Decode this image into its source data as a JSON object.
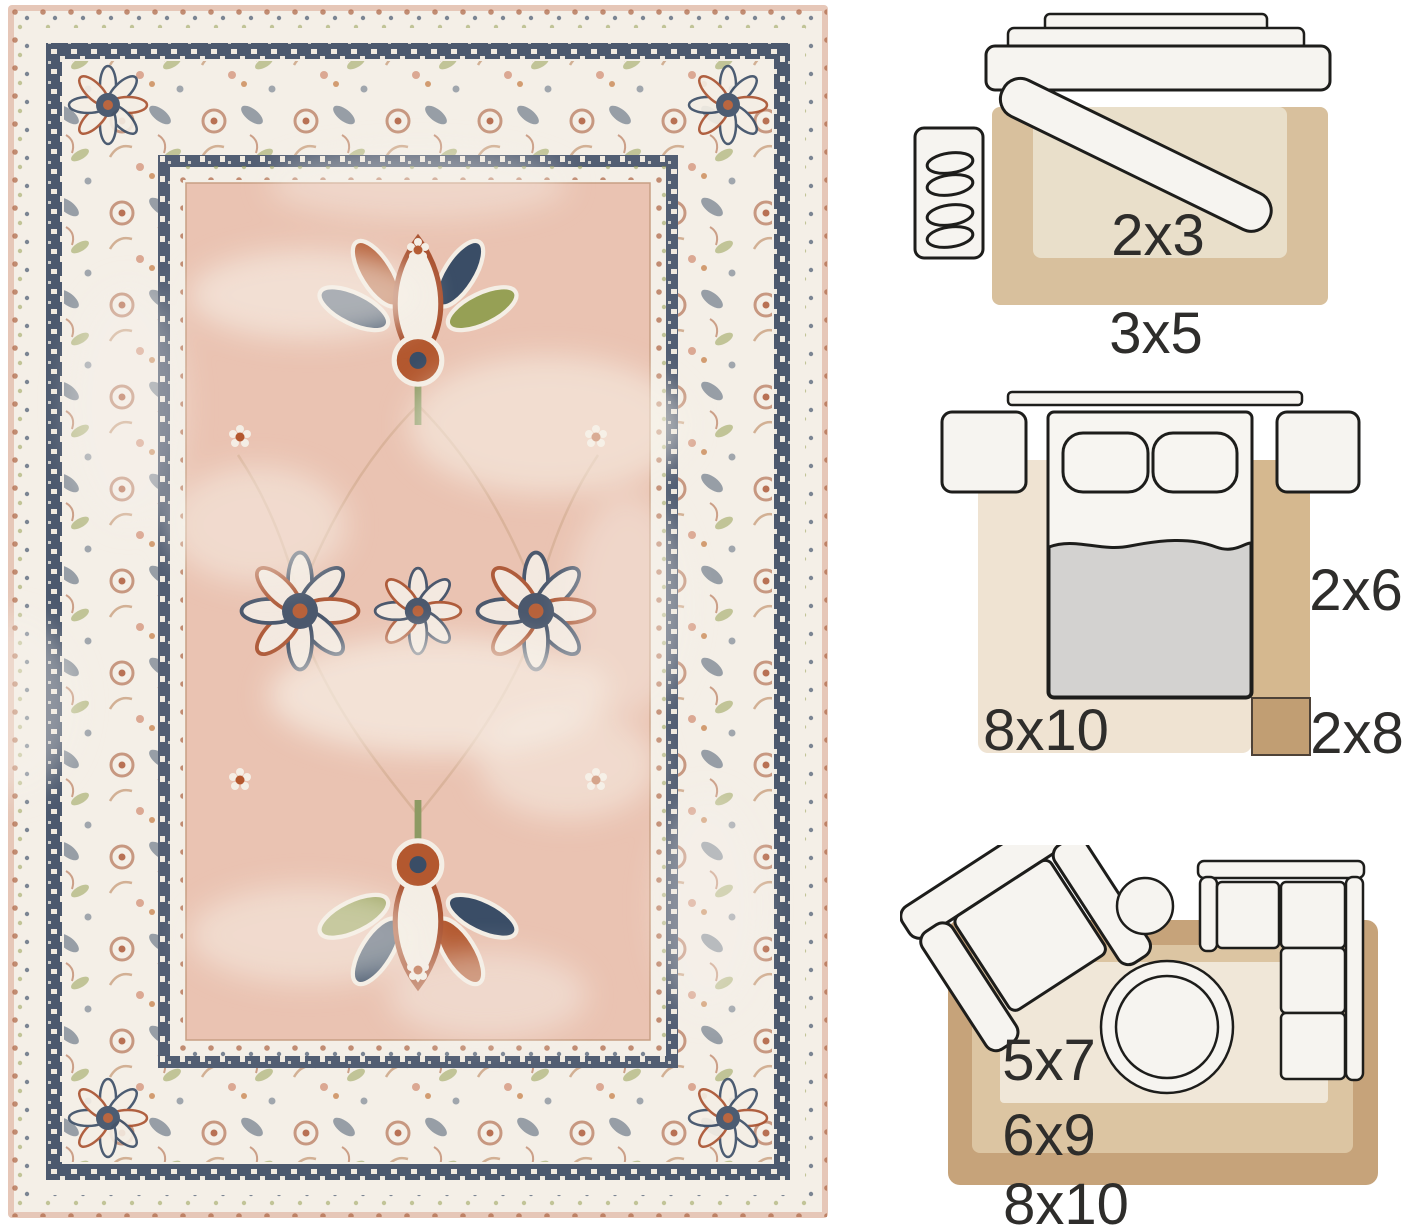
{
  "page": {
    "type": "rug product photo with size guide diagrams",
    "background": "#ffffff"
  },
  "rug_photo": {
    "description": "Distressed vintage oriental area rug, blush pink field, ivory floral border, navy meander bands, rust and olive floral motifs",
    "palette": {
      "edge_blush": "#e6c7b8",
      "border_ivory": "#f4efe7",
      "meander_navy": "#35455e",
      "field_pink": "#eac3b2",
      "accent_navy": "#3a4d66",
      "accent_rust": "#a9512f",
      "accent_olive": "#96a055",
      "motif_cream": "#f4eee5"
    }
  },
  "size_guide": {
    "entryway": {
      "labels": {
        "inner": "2x3",
        "outer": "3x5"
      },
      "rug_colors": {
        "outer": "#d8c09d",
        "inner": "#e9dfca"
      },
      "furniture": [
        "console table",
        "leaning bench",
        "shoe mat"
      ]
    },
    "bedroom": {
      "labels": {
        "area": "8x10",
        "runner": "2x6",
        "long_runner": "2x8"
      },
      "rug_colors": {
        "area": "#efe3d2",
        "runner": "#d5b88f",
        "long_runner": "#c19e73"
      },
      "furniture": [
        "headboard",
        "nightstand",
        "bed",
        "pillows",
        "blanket"
      ]
    },
    "living_room": {
      "labels": {
        "small": "5x7",
        "medium": "6x9",
        "large": "8x10"
      },
      "rug_colors": {
        "small": "#f0e7d8",
        "medium": "#dcc5a2",
        "large": "#c6a37a"
      },
      "furniture": [
        "armchair",
        "side table",
        "sectional sofa",
        "round coffee table"
      ]
    }
  },
  "diagram_style": {
    "outline": "#1d1d1b",
    "furniture_fill": "#f6f4f0",
    "blanket_grey": "#d3d2d0",
    "label_color": "#2e2d2b"
  }
}
